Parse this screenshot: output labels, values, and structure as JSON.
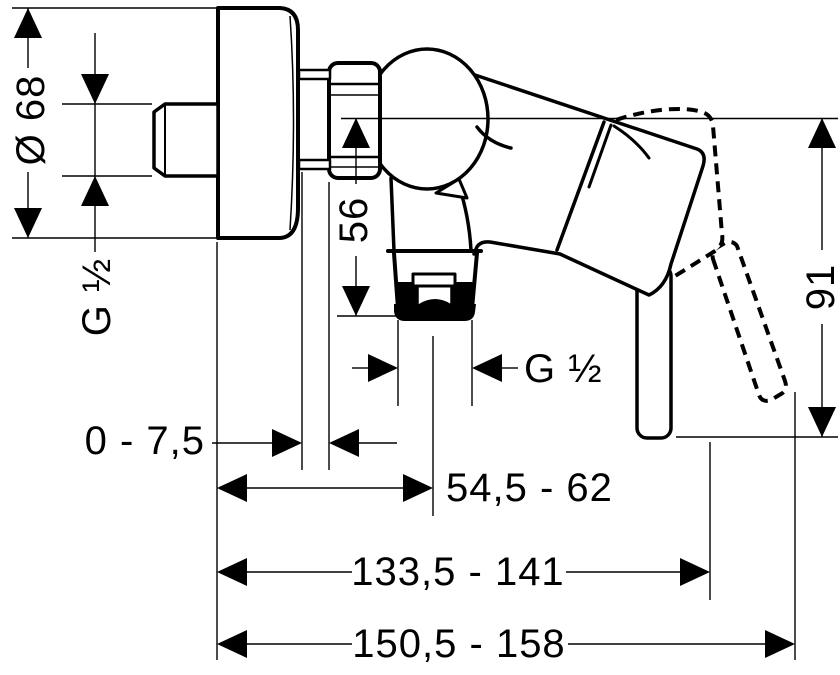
{
  "drawing": {
    "kind": "technical dimension drawing",
    "subject": "wall-mounted single-lever shower mixer, side view",
    "colors": {
      "line": "#000000",
      "background": "#ffffff"
    }
  },
  "dims": {
    "escutcheon_diameter": {
      "label": "Ø 68",
      "orientation": "vertical"
    },
    "wall_thread": {
      "label": "G ½",
      "orientation": "vertical"
    },
    "axis_to_outlet": {
      "label": "56",
      "orientation": "vertical"
    },
    "outlet_thread": {
      "label": "G ½",
      "orientation": "horizontal"
    },
    "wall_clearance": {
      "label": "0 - 7,5",
      "orientation": "horizontal"
    },
    "wall_to_outlet_axis": {
      "label": "54,5 - 62",
      "orientation": "horizontal"
    },
    "wall_to_lever_closed": {
      "label": "133,5 - 141",
      "orientation": "horizontal"
    },
    "wall_to_lever_open": {
      "label": "150,5 - 158",
      "orientation": "horizontal"
    },
    "axis_to_lever_tip": {
      "label": "91",
      "orientation": "vertical"
    }
  }
}
